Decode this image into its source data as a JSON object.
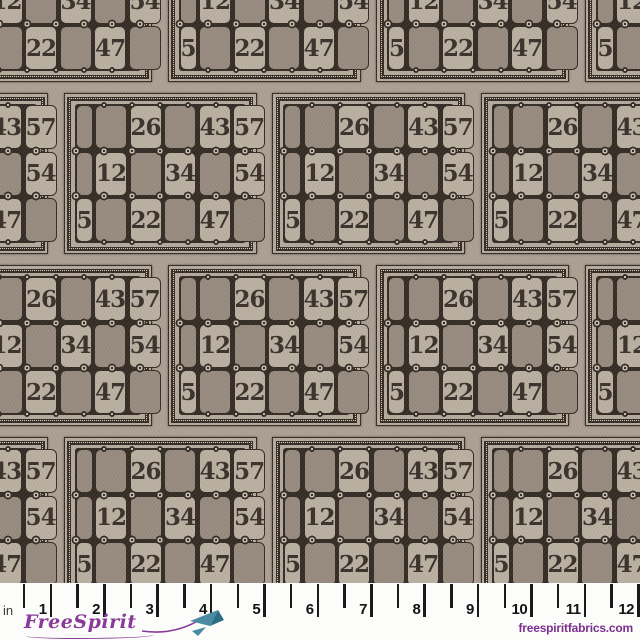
{
  "pattern": {
    "card_numbers": [
      [
        "",
        "",
        "26",
        "",
        "43",
        "57"
      ],
      [
        "",
        "12",
        "",
        "34",
        "",
        "54"
      ],
      [
        "5",
        "",
        "22",
        "",
        "47",
        ""
      ]
    ]
  },
  "ruler": {
    "unit_label": "in",
    "inch_labels": [
      "1",
      "2",
      "3",
      "4",
      "5",
      "6",
      "7",
      "8",
      "9",
      "10",
      "11",
      "12"
    ]
  },
  "branding": {
    "logo_text": "FreeSpirit",
    "website": "freespiritfabrics.com"
  },
  "colors": {
    "fabric_base": "#aba093",
    "card_margin": "#b5aa9c",
    "cell_light": "#bab0a2",
    "cell_dark": "#978b7f",
    "line_dark": "#332c25",
    "digit": "#39312a",
    "bead_fill": "#c9beae",
    "dot_light": "#d9cfbe",
    "ruler_bg": "#fcfcfa",
    "tick": "#1a1a1a",
    "logo_purple": "#8a3a98",
    "website_purple": "#7b2f8e",
    "plane_teal": "#4a8ba3",
    "plane_teal_dark": "#2e6e85"
  }
}
